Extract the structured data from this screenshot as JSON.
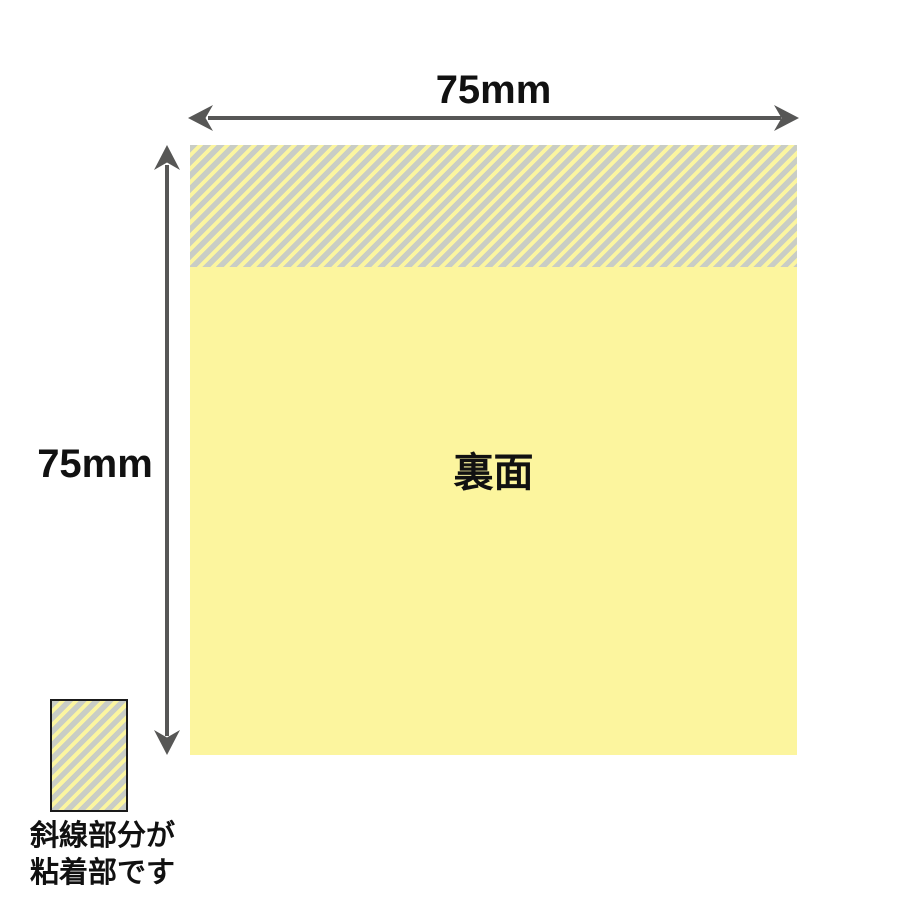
{
  "diagram": {
    "width_label": "75mm",
    "height_label": "75mm",
    "back_side_label": "裏面",
    "legend_line1": "斜線部分が",
    "legend_line2": "粘着部です"
  },
  "colors": {
    "note_yellow": "#FCF59E",
    "adhesive_stripe_gray": "#C9CDC5",
    "adhesive_stripe_yellow": "#FBF5A0",
    "dimension_arrow": "#575756",
    "text": "#111111",
    "legend_swatch_border": "#1A1A1A"
  }
}
